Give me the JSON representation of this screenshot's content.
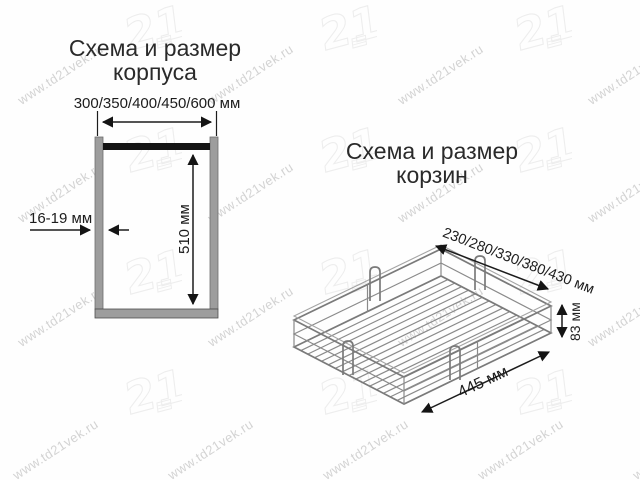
{
  "watermark": {
    "text": "www.td21vek.ru",
    "logo_text": "21"
  },
  "left_diagram": {
    "title_line1": "Схема и размер",
    "title_line2": "корпуса",
    "width_label": "300/350/400/450/600 мм",
    "thickness_label": "16-19 мм",
    "height_label": "510 мм"
  },
  "right_diagram": {
    "title_line1": "Схема и размер",
    "title_line2": "корзин",
    "width_label": "230/280/330/380/430 мм",
    "height_label": "83 мм",
    "depth_label": "445 мм"
  },
  "colors": {
    "bg": "#fefefe",
    "ink": "#1c1c1c",
    "title": "#2a2a2a",
    "gray-fill": "#9d9d9d",
    "wire": "#8a8a8a",
    "watermark": "#b0b0b0",
    "logo": "#cfcfcf"
  }
}
